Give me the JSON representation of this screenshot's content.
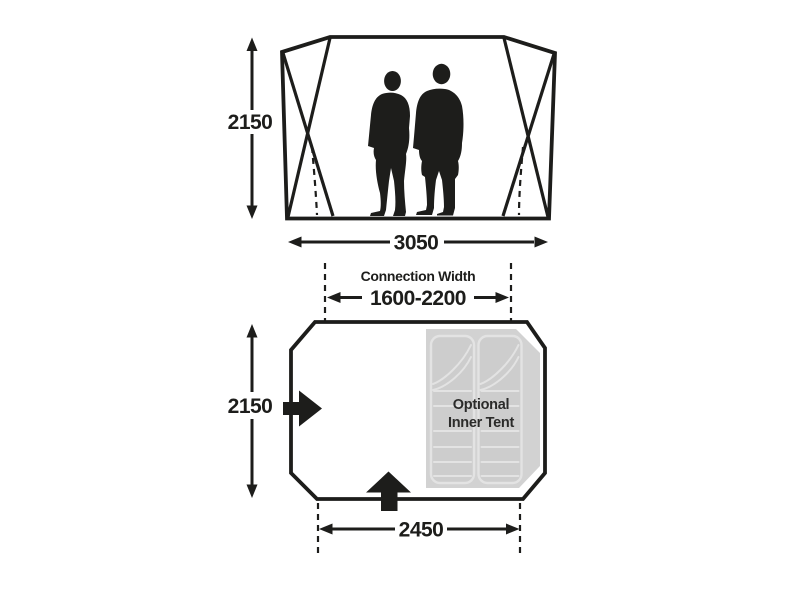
{
  "diagram_title": "Tent dimensions diagram",
  "colors": {
    "ink": "#1d1d1b",
    "inner_tent_panel": "#d2d2d2",
    "sleeping_bag_fill": "#cdcdcd",
    "sleeping_bag_line": "#e3e3e3",
    "label_dark": "#2b2b2a",
    "background": "#ffffff"
  },
  "front_view": {
    "height_mm": "2150",
    "width_mm": "3050"
  },
  "plan_view": {
    "connection_width_title": "Connection Width",
    "connection_width_range": "1600-2200",
    "depth_mm": "2150",
    "front_width_mm": "2450",
    "inner_tent": {
      "line1": "Optional",
      "line2": "Inner Tent"
    }
  }
}
